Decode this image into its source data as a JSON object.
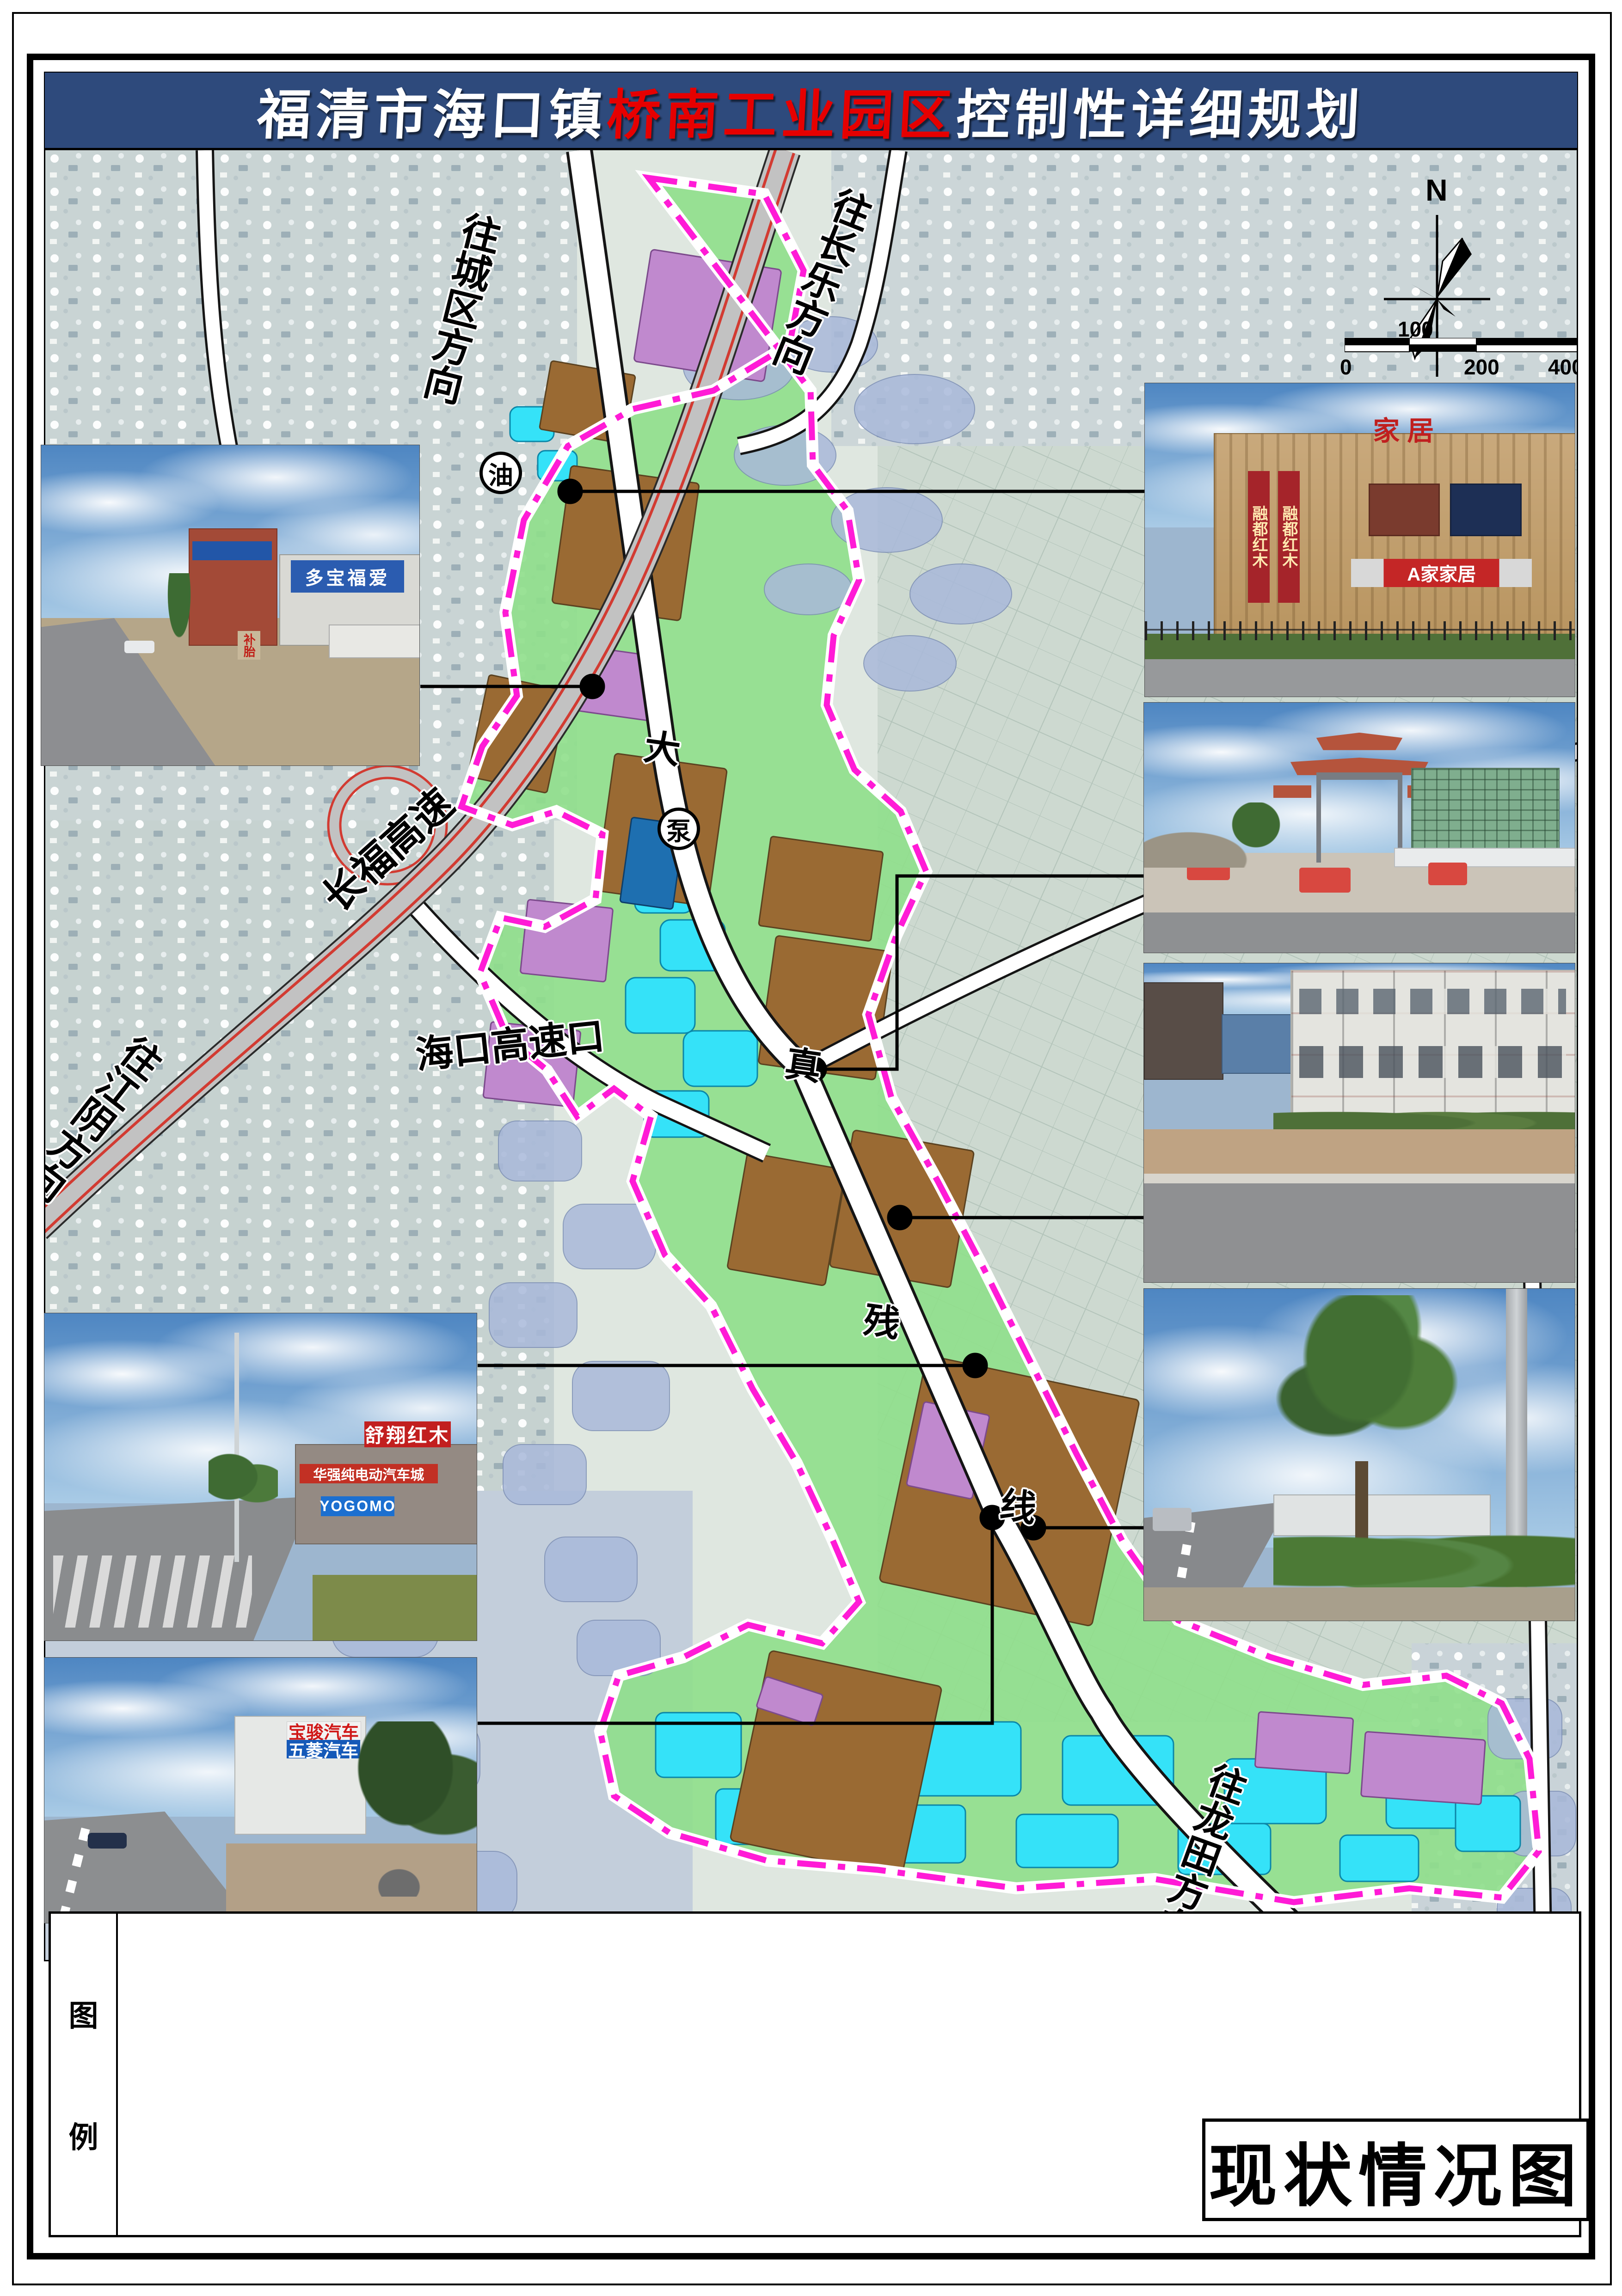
{
  "title": {
    "part1": "福清市海口镇",
    "highlight": "桥南工业园区",
    "part2": "控制性详细规划"
  },
  "compass": {
    "north_label": "N"
  },
  "scale_bar": {
    "above_label": "100",
    "zero_label": "0",
    "mid_label": "200",
    "end_label": "400m"
  },
  "map_labels": {
    "to_city": "往城区方向",
    "to_changle": "往长乐方向",
    "changfu_expressway": "长福高速",
    "haikou_exit": "海口高速口",
    "to_jiangyin": "往江阴方向",
    "to_longtian": "往龙田方向",
    "road_char_da": "大",
    "road_char_zhen": "真",
    "road_char_can": "残",
    "road_char_xian": "线",
    "gas_station": "油",
    "pump_station": "泵"
  },
  "legend": {
    "char_top": "图",
    "char_bottom": "例"
  },
  "caption": {
    "text": "现状情况图"
  },
  "photos": {
    "left_top": {
      "blue_sign": "多宝福爱",
      "tire_sign": "补胎"
    },
    "left_mid": {
      "roof_sign": "舒翔红木",
      "red_banner": "华强纯电动汽车城",
      "blue_band": "YOGOMO"
    },
    "left_bottom": {
      "sign_top": "宝骏汽车",
      "sign_bottom": "五菱汽车"
    },
    "right_1": {
      "roof_sign": "家居",
      "banner": "融都红木",
      "storefront": "A家家居"
    }
  }
}
